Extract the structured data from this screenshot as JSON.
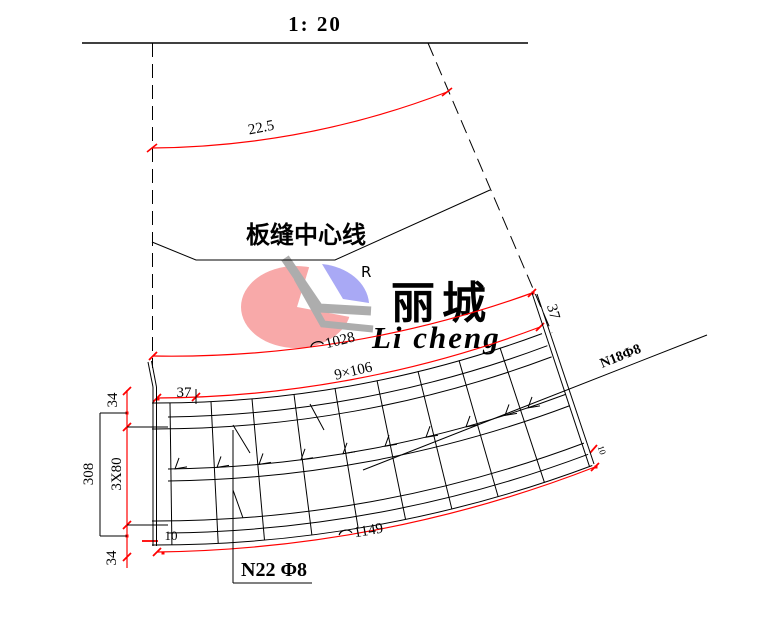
{
  "drawing": {
    "scale_title": "1: 20",
    "joint_label": "板缝中心线",
    "dim_arc_top": "22.5",
    "dim_arc_upper": {
      "prefix": "⌒",
      "value": "1028"
    },
    "dim_spacing": "9×106",
    "dim_offset_left": "37",
    "dim_offset_right": "37",
    "dim_side_top": "34",
    "dim_side_total": "308",
    "dim_side_mid": "3X80",
    "dim_side_bottom": "34",
    "dim_ten_left": "10",
    "dim_ten_right": "10",
    "dim_arc_lower": {
      "prefix": "⌒",
      "value": "1149"
    },
    "bar_label_right": "N18Φ8",
    "bar_label_bottom": "N22 Φ8"
  },
  "logo": {
    "registered": "R",
    "name_cn": "丽城",
    "name_en": "Li cheng"
  },
  "colors": {
    "line": "#000000",
    "dimension_red": "#ff0000",
    "logo_pink": "#f8a9a9",
    "logo_blue": "#a9a9f5",
    "logo_gray": "#adadad",
    "watermark_text": "#b0b0b0"
  }
}
